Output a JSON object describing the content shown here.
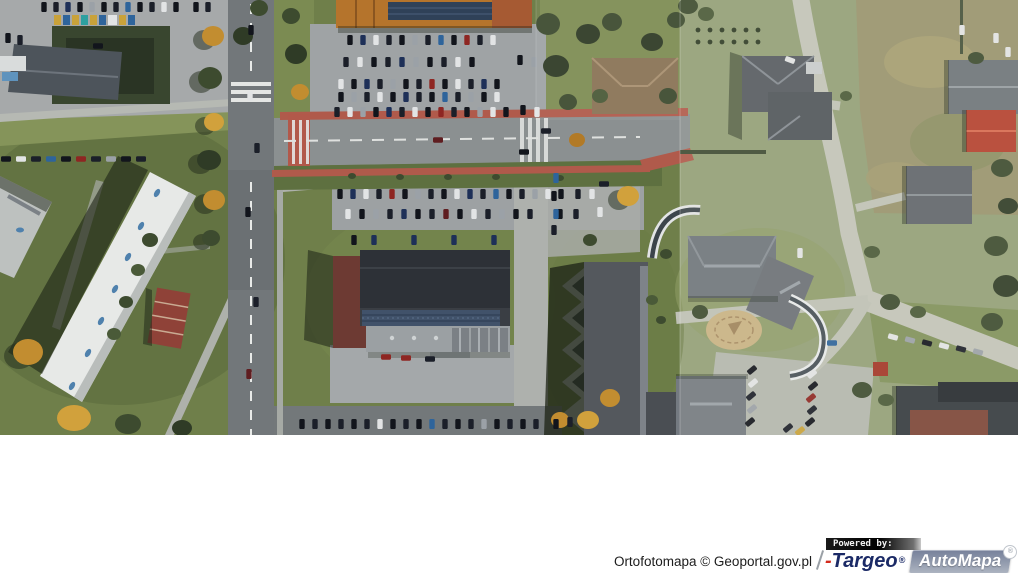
{
  "attribution": {
    "text": "Ortofotomapa © Geoportal.gov.pl"
  },
  "logo": {
    "powered_by": "Powered by:",
    "targeo_dash": "-",
    "targeo": "Targeo",
    "registered_mark": "®",
    "automapa": "AutoMapa",
    "colors": {
      "targeo_navy": "#1b2a66",
      "targeo_red": "#d42a1c",
      "automapa_gray": "#8d96a8",
      "powered_bar_black": "#000000"
    }
  }
}
